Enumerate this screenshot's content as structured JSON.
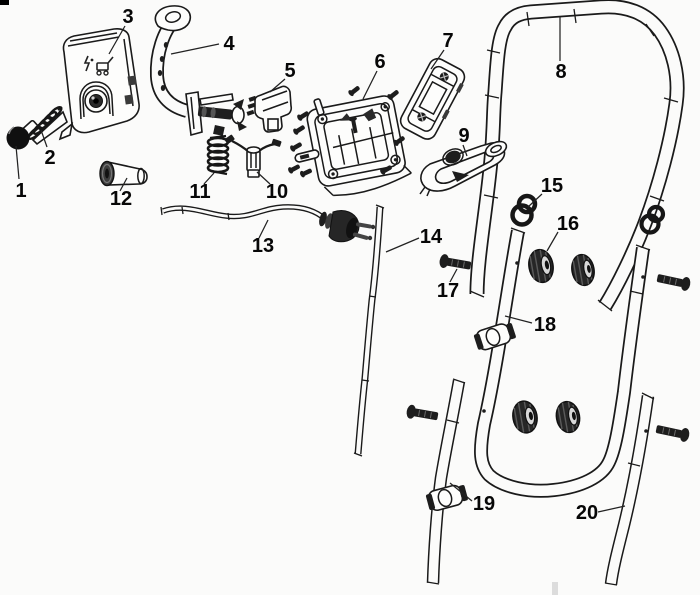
{
  "colors": {
    "background": "#fbfbfa",
    "line_art": "#1a1a1a",
    "label_text": "#070707",
    "dark_fill": "#1d1d1d"
  },
  "diagram": {
    "callouts": [
      {
        "number": "1"
      },
      {
        "number": "2"
      },
      {
        "number": "3"
      },
      {
        "number": "4"
      },
      {
        "number": "5"
      },
      {
        "number": "6"
      },
      {
        "number": "7"
      },
      {
        "number": "8"
      },
      {
        "number": "9"
      },
      {
        "number": "10"
      },
      {
        "number": "11"
      },
      {
        "number": "12"
      },
      {
        "number": "13"
      },
      {
        "number": "14"
      },
      {
        "number": "15"
      },
      {
        "number": "16"
      },
      {
        "number": "17"
      },
      {
        "number": "18"
      },
      {
        "number": "19"
      },
      {
        "number": "20"
      }
    ]
  }
}
